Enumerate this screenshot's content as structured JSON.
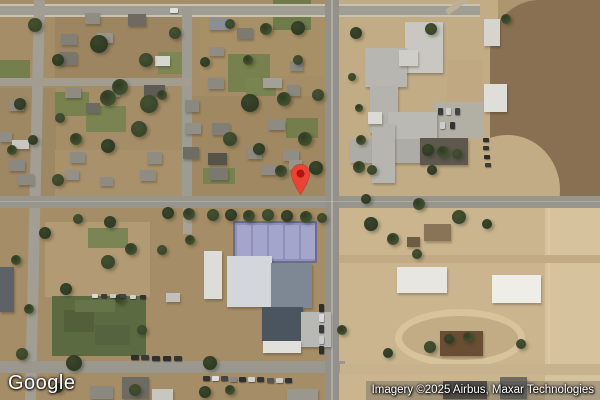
{
  "branding": {
    "logo_text": "Google"
  },
  "attribution": {
    "text": "Imagery ©2025 Airbus, Maxar Technologies"
  },
  "marker": {
    "name": "location-pin",
    "fill": "#EA4335",
    "dot": "#B31412",
    "tip_x": 300,
    "tip_y": 196
  },
  "palette": {
    "ground_base": "#ad9570",
    "residential": "#a58d67",
    "school_grounds": "#c2ac86",
    "plowed_field": "#8a7053",
    "sand": "#d6c29c",
    "road_gray": "#98958d",
    "tree_green": "#3a452c",
    "sports_field_green": "#5c6a41",
    "tennis_court": "#a3a5cb"
  },
  "features": {
    "zones": [
      [
        0,
        0,
        342,
        207,
        "#a58d67"
      ],
      [
        338,
        0,
        160,
        207,
        "#c2ac86"
      ],
      [
        490,
        0,
        110,
        207,
        "#8a7053",
        "45% 0 0 40% / 25% 0 0 35%"
      ],
      [
        455,
        135,
        105,
        110,
        "#c2ac86",
        "50%"
      ],
      [
        0,
        207,
        342,
        193,
        "#a58d67"
      ],
      [
        338,
        207,
        262,
        193,
        "#cab58f"
      ],
      [
        545,
        207,
        55,
        193,
        "#d6c29c"
      ],
      [
        55,
        12,
        130,
        66,
        "#9c8560"
      ],
      [
        200,
        14,
        136,
        62,
        "#a89066"
      ],
      [
        0,
        88,
        56,
        118,
        "#9e8763"
      ],
      [
        186,
        96,
        150,
        108,
        "#a08862"
      ],
      [
        55,
        150,
        130,
        55,
        "#a9916c"
      ],
      [
        447,
        60,
        36,
        44,
        "#c0a982"
      ],
      [
        45,
        222,
        105,
        75,
        "#b29a74"
      ],
      [
        52,
        296,
        94,
        60,
        "#5c6a41"
      ],
      [
        64,
        310,
        30,
        22,
        "#525f3a"
      ],
      [
        95,
        325,
        35,
        20,
        "#566340"
      ],
      [
        75,
        300,
        40,
        12,
        "#667449"
      ],
      [
        548,
        207,
        2,
        160,
        "#dcc8a2"
      ]
    ],
    "lawns": [
      [
        228,
        54,
        42,
        38,
        "#77814f"
      ],
      [
        273,
        0,
        38,
        30,
        "#6f7b4a"
      ],
      [
        86,
        106,
        40,
        26,
        "#7a8452"
      ],
      [
        55,
        92,
        34,
        24,
        "#78824f"
      ],
      [
        158,
        52,
        30,
        22,
        "#7d8754"
      ],
      [
        286,
        118,
        32,
        20,
        "#747e4c"
      ],
      [
        203,
        168,
        32,
        16,
        "#78824f"
      ],
      [
        246,
        78,
        30,
        18,
        "#7a8452"
      ],
      [
        0,
        60,
        30,
        20,
        "#757f4d"
      ],
      [
        88,
        228,
        40,
        20,
        "#7a8455"
      ]
    ],
    "track": {
      "x": 395,
      "y": 309,
      "w": 130,
      "h": 58,
      "border_color": "#d8c49c",
      "border_w": 7
    },
    "roads": [
      [
        0,
        4,
        480,
        2,
        "#c8c2b0"
      ],
      [
        0,
        6,
        480,
        9,
        "#a09d94"
      ],
      [
        0,
        15,
        480,
        2,
        "#c8c2b0"
      ],
      [
        182,
        6,
        10,
        192,
        "#9e9b93"
      ],
      [
        34,
        0,
        11,
        402,
        "#a29e94",
        null,
        1.3
      ],
      [
        0,
        78,
        190,
        8,
        "#a39d90"
      ],
      [
        0,
        196,
        600,
        12,
        "#98958d"
      ],
      [
        0,
        361,
        345,
        12,
        "#9a978f"
      ],
      [
        340,
        364,
        260,
        11,
        "#c6b28c"
      ],
      [
        339,
        255,
        261,
        8,
        "#c2ab84"
      ],
      [
        325,
        0,
        14,
        400,
        "#94918a"
      ],
      [
        331,
        0,
        2,
        400,
        "rgba(240,240,230,0.30)"
      ],
      [
        0,
        201,
        600,
        1,
        "rgba(240,240,230,0.22)"
      ],
      [
        183,
        208,
        9,
        26,
        "#a8a296"
      ],
      [
        433,
        102,
        50,
        36,
        "#b2afa5"
      ],
      [
        445,
        10,
        36,
        6,
        "#bcb096",
        null,
        -35
      ]
    ],
    "buildings": [
      [
        85,
        13,
        15,
        11,
        "#8f8c86"
      ],
      [
        128,
        14,
        18,
        12,
        "#6e6a62"
      ],
      [
        209,
        18,
        20,
        12,
        "#8a8e96"
      ],
      [
        237,
        28,
        16,
        11,
        "#7d7a72"
      ],
      [
        97,
        33,
        16,
        10,
        "#97948c"
      ],
      [
        61,
        34,
        16,
        11,
        "#837f76"
      ],
      [
        155,
        56,
        15,
        10,
        "#d8d6d0"
      ],
      [
        209,
        47,
        15,
        9,
        "#8f8c84"
      ],
      [
        59,
        52,
        18,
        13,
        "#7a766c"
      ],
      [
        290,
        61,
        13,
        10,
        "#8b8880"
      ],
      [
        65,
        87,
        16,
        11,
        "#8f8b82"
      ],
      [
        107,
        88,
        13,
        9,
        "#938f86"
      ],
      [
        144,
        85,
        21,
        12,
        "#5f5c55"
      ],
      [
        208,
        78,
        16,
        11,
        "#8c8980"
      ],
      [
        263,
        78,
        19,
        10,
        "#a3a099"
      ],
      [
        287,
        85,
        13,
        11,
        "#8a8780"
      ],
      [
        9,
        100,
        15,
        11,
        "#8e8b84"
      ],
      [
        86,
        103,
        14,
        10,
        "#6d6a62"
      ],
      [
        0,
        132,
        12,
        10,
        "#908d85"
      ],
      [
        12,
        140,
        17,
        9,
        "#c9c7c1"
      ],
      [
        185,
        100,
        14,
        12,
        "#8b8880"
      ],
      [
        185,
        123,
        16,
        11,
        "#928f87"
      ],
      [
        212,
        123,
        18,
        12,
        "#817e76"
      ],
      [
        268,
        120,
        17,
        10,
        "#8e8b83"
      ],
      [
        9,
        160,
        16,
        11,
        "#8b8880"
      ],
      [
        70,
        152,
        15,
        11,
        "#8e8b83"
      ],
      [
        147,
        152,
        15,
        12,
        "#8f8c84"
      ],
      [
        183,
        147,
        16,
        12,
        "#6f6c64"
      ],
      [
        208,
        153,
        19,
        12,
        "#565349"
      ],
      [
        247,
        148,
        15,
        11,
        "#8d8a82"
      ],
      [
        283,
        150,
        16,
        11,
        "#908d85"
      ],
      [
        18,
        174,
        16,
        11,
        "#8c8980"
      ],
      [
        65,
        170,
        14,
        10,
        "#93908a"
      ],
      [
        140,
        170,
        16,
        11,
        "#8f8c84"
      ],
      [
        210,
        168,
        18,
        12,
        "#7b7870"
      ],
      [
        261,
        165,
        15,
        10,
        "#8e8b83"
      ],
      [
        289,
        160,
        13,
        10,
        "#979489"
      ],
      [
        100,
        177,
        13,
        9,
        "#8e8b83"
      ],
      [
        405,
        22,
        38,
        51,
        "#c9c7c1"
      ],
      [
        365,
        48,
        42,
        39,
        "#b8b6b0"
      ],
      [
        399,
        50,
        19,
        16,
        "#d0cec8"
      ],
      [
        370,
        86,
        28,
        47,
        "#b5b3ad"
      ],
      [
        388,
        112,
        49,
        30,
        "#bbb9b3"
      ],
      [
        350,
        139,
        73,
        24,
        "#aeaca6"
      ],
      [
        372,
        124,
        23,
        59,
        "#b7b5af"
      ],
      [
        420,
        138,
        48,
        27,
        "#5e584e"
      ],
      [
        368,
        112,
        14,
        12,
        "#dcdad4"
      ],
      [
        484,
        19,
        16,
        27,
        "#d6d4ce"
      ],
      [
        484,
        84,
        23,
        28,
        "#e0ded8"
      ],
      [
        424,
        224,
        27,
        17,
        "#8a7458"
      ],
      [
        407,
        237,
        13,
        10,
        "#6f5c44"
      ],
      [
        204,
        251,
        18,
        48,
        "#dcdcd8"
      ],
      [
        227,
        256,
        45,
        51,
        "#d3d7db"
      ],
      [
        271,
        263,
        41,
        45,
        "#7e8894"
      ],
      [
        262,
        307,
        41,
        34,
        "#4a5560"
      ],
      [
        301,
        312,
        30,
        35,
        "#b8b8b4"
      ],
      [
        166,
        293,
        14,
        9,
        "#c2c0ba"
      ],
      [
        263,
        341,
        38,
        12,
        "#e2e0da"
      ],
      [
        397,
        267,
        50,
        26,
        "#e8e6e0"
      ],
      [
        492,
        275,
        49,
        28,
        "#efede7"
      ],
      [
        440,
        331,
        43,
        25,
        "#6a4e34"
      ],
      [
        443,
        381,
        44,
        18,
        "#55504a"
      ],
      [
        500,
        377,
        27,
        22,
        "#6e6b63"
      ],
      [
        90,
        386,
        23,
        13,
        "#8b8880"
      ],
      [
        122,
        377,
        27,
        22,
        "#6e6b63"
      ],
      [
        152,
        389,
        21,
        11,
        "#c8c6c0"
      ],
      [
        287,
        389,
        31,
        11,
        "#9a978f"
      ],
      [
        0,
        267,
        14,
        45,
        "#5d6268"
      ]
    ],
    "tennis_courts": {
      "frame": [
        233,
        221,
        84,
        42,
        "#696c8e"
      ],
      "surface": [
        235,
        223,
        80,
        38,
        "#8e90b8"
      ],
      "court_xs": [
        237,
        253,
        269,
        285,
        301
      ],
      "court_y": 225,
      "court_w": 14,
      "court_h": 34,
      "court_color": "#a3a5cb"
    },
    "trees": [
      [
        35,
        25,
        7
      ],
      [
        99,
        44,
        9
      ],
      [
        120,
        87,
        8
      ],
      [
        146,
        60,
        7
      ],
      [
        58,
        60,
        6
      ],
      [
        108,
        98,
        8
      ],
      [
        149,
        104,
        9
      ],
      [
        250,
        103,
        9
      ],
      [
        284,
        99,
        7
      ],
      [
        139,
        129,
        8
      ],
      [
        108,
        146,
        7
      ],
      [
        76,
        139,
        6
      ],
      [
        230,
        139,
        7
      ],
      [
        259,
        149,
        6
      ],
      [
        305,
        139,
        7
      ],
      [
        318,
        95,
        6
      ],
      [
        298,
        28,
        7
      ],
      [
        266,
        29,
        6
      ],
      [
        230,
        24,
        5
      ],
      [
        316,
        168,
        7
      ],
      [
        281,
        171,
        6
      ],
      [
        58,
        180,
        6
      ],
      [
        20,
        104,
        6
      ],
      [
        12,
        150,
        5
      ],
      [
        175,
        33,
        6
      ],
      [
        205,
        62,
        5
      ],
      [
        162,
        95,
        5
      ],
      [
        60,
        118,
        5
      ],
      [
        33,
        140,
        5
      ],
      [
        248,
        60,
        5
      ],
      [
        298,
        60,
        5
      ],
      [
        168,
        213,
        6
      ],
      [
        189,
        214,
        6
      ],
      [
        213,
        215,
        6
      ],
      [
        231,
        215,
        6
      ],
      [
        249,
        216,
        6
      ],
      [
        268,
        215,
        6
      ],
      [
        287,
        216,
        6
      ],
      [
        306,
        217,
        6
      ],
      [
        322,
        218,
        5
      ],
      [
        45,
        233,
        6
      ],
      [
        16,
        260,
        5
      ],
      [
        78,
        219,
        5
      ],
      [
        110,
        222,
        6
      ],
      [
        131,
        249,
        6
      ],
      [
        108,
        262,
        7
      ],
      [
        66,
        289,
        6
      ],
      [
        29,
        309,
        5
      ],
      [
        22,
        354,
        6
      ],
      [
        74,
        363,
        8
      ],
      [
        120,
        299,
        5
      ],
      [
        142,
        330,
        5
      ],
      [
        210,
        363,
        7
      ],
      [
        190,
        240,
        5
      ],
      [
        162,
        250,
        5
      ],
      [
        371,
        224,
        7
      ],
      [
        393,
        239,
        6
      ],
      [
        417,
        254,
        5
      ],
      [
        366,
        199,
        5
      ],
      [
        419,
        204,
        6
      ],
      [
        459,
        217,
        7
      ],
      [
        487,
        224,
        5
      ],
      [
        506,
        19,
        5
      ],
      [
        431,
        29,
        6
      ],
      [
        356,
        33,
        6
      ],
      [
        361,
        140,
        5
      ],
      [
        430,
        347,
        6
      ],
      [
        449,
        339,
        5
      ],
      [
        468,
        337,
        5
      ],
      [
        521,
        344,
        5
      ],
      [
        388,
        353,
        5
      ],
      [
        359,
        167,
        6
      ],
      [
        372,
        170,
        5
      ],
      [
        428,
        150,
        6
      ],
      [
        443,
        152,
        6
      ],
      [
        457,
        154,
        5
      ],
      [
        432,
        170,
        5
      ],
      [
        359,
        108,
        4
      ],
      [
        352,
        77,
        4
      ],
      [
        205,
        392,
        6
      ],
      [
        230,
        390,
        5
      ],
      [
        135,
        390,
        6
      ],
      [
        58,
        388,
        5
      ],
      [
        342,
        330,
        5
      ]
    ],
    "cars": [
      [
        319,
        304,
        5,
        8,
        "#2e2e2e"
      ],
      [
        319,
        314,
        5,
        8,
        "#d8d8d4"
      ],
      [
        319,
        325,
        5,
        8,
        "#3a3a3a"
      ],
      [
        319,
        336,
        5,
        8,
        "#caccc8"
      ],
      [
        319,
        346,
        5,
        8,
        "#2e2e2e"
      ],
      [
        203,
        376,
        7,
        5,
        "#333333"
      ],
      [
        212,
        376,
        7,
        5,
        "#dddddd"
      ],
      [
        221,
        376,
        7,
        5,
        "#444444"
      ],
      [
        230,
        377,
        7,
        5,
        "#888888"
      ],
      [
        239,
        377,
        7,
        5,
        "#2e2e2e"
      ],
      [
        248,
        377,
        7,
        5,
        "#d0d0cc"
      ],
      [
        257,
        377,
        7,
        5,
        "#333333"
      ],
      [
        267,
        378,
        7,
        5,
        "#555555"
      ],
      [
        276,
        378,
        7,
        5,
        "#cccccc"
      ],
      [
        285,
        378,
        7,
        5,
        "#333333"
      ],
      [
        92,
        294,
        6,
        4,
        "#d8d8d4"
      ],
      [
        101,
        294,
        6,
        4,
        "#3a3a3a"
      ],
      [
        110,
        294,
        6,
        4,
        "#c8c8c4"
      ],
      [
        120,
        294,
        6,
        4,
        "#444444"
      ],
      [
        130,
        295,
        6,
        4,
        "#d0d0cc"
      ],
      [
        140,
        295,
        6,
        4,
        "#333333"
      ],
      [
        131,
        355,
        8,
        5,
        "#2e2e2e"
      ],
      [
        141,
        355,
        8,
        5,
        "#3a3a3a"
      ],
      [
        152,
        356,
        8,
        5,
        "#303030"
      ],
      [
        163,
        356,
        8,
        5,
        "#2e2e2e"
      ],
      [
        174,
        356,
        8,
        5,
        "#343434"
      ],
      [
        483,
        138,
        6,
        4,
        "#2f2f2f"
      ],
      [
        483,
        146,
        6,
        4,
        "#343434"
      ],
      [
        484,
        155,
        6,
        4,
        "#2b2b2b"
      ],
      [
        485,
        163,
        6,
        4,
        "#3c3c3c"
      ],
      [
        170,
        8,
        8,
        5,
        "#e0e0dc"
      ],
      [
        438,
        108,
        5,
        7,
        "#3a3a3a"
      ],
      [
        446,
        108,
        5,
        7,
        "#d0d0cc"
      ],
      [
        455,
        108,
        5,
        7,
        "#444444"
      ],
      [
        440,
        122,
        5,
        7,
        "#cccccc"
      ],
      [
        450,
        122,
        5,
        7,
        "#333333"
      ]
    ]
  }
}
